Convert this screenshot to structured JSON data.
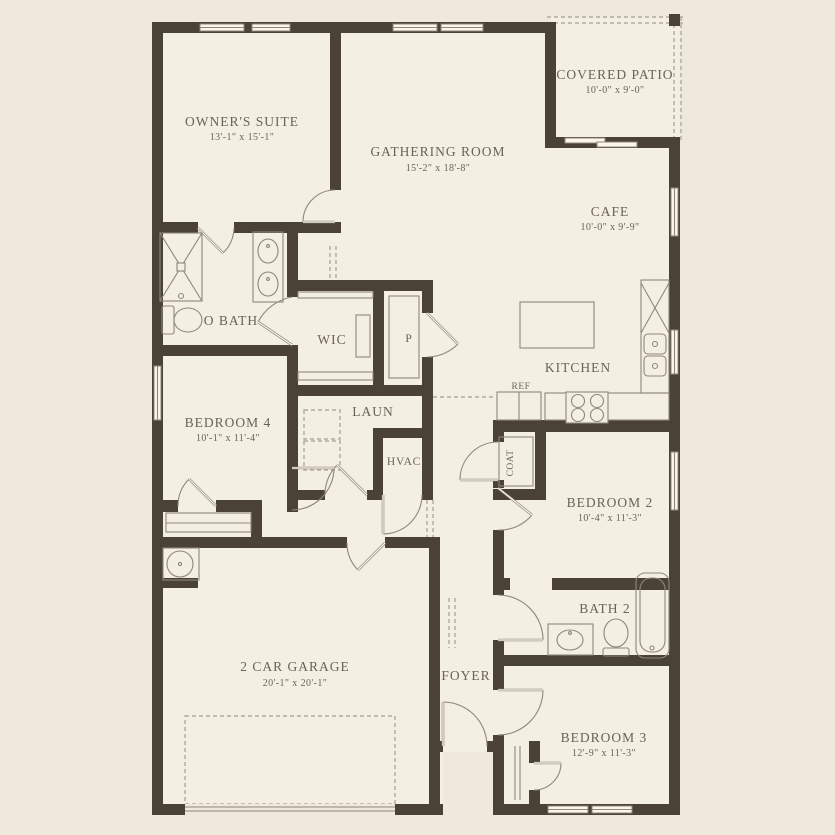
{
  "colors": {
    "wall": "#4b4236",
    "floor": "#f4efe3",
    "background": "#efe9dc",
    "line": "#8f8778",
    "dash": "#a89f8e",
    "text": "#6b6355"
  },
  "rooms": {
    "owners_suite": {
      "name": "OWNER'S SUITE",
      "dims": "13'-1\" x 15'-1\""
    },
    "gathering_room": {
      "name": "GATHERING ROOM",
      "dims": "15'-2\" x 18'-8\""
    },
    "covered_patio": {
      "name": "COVERED PATIO",
      "dims": "10'-0\" x 9'-0\""
    },
    "cafe": {
      "name": "CAFE",
      "dims": "10'-0\" x 9'-9\""
    },
    "kitchen": {
      "name": "KITCHEN"
    },
    "owners_bath": {
      "name": "O BATH"
    },
    "wic": {
      "name": "WIC"
    },
    "pantry": {
      "name": "P"
    },
    "laundry": {
      "name": "LAUN"
    },
    "hvac": {
      "name": "HVAC"
    },
    "refrigerator": {
      "name": "REF"
    },
    "coat": {
      "name": "COAT"
    },
    "bedroom4": {
      "name": "BEDROOM 4",
      "dims": "10'-1\" x 11'-4\""
    },
    "bedroom2": {
      "name": "BEDROOM 2",
      "dims": "10'-4\" x 11'-3\""
    },
    "bath2": {
      "name": "BATH 2"
    },
    "bedroom3": {
      "name": "BEDROOM 3",
      "dims": "12'-9\" x 11'-3\""
    },
    "garage": {
      "name": "2 CAR GARAGE",
      "dims": "20'-1\" x 20'-1\""
    },
    "foyer": {
      "name": "FOYER"
    }
  }
}
